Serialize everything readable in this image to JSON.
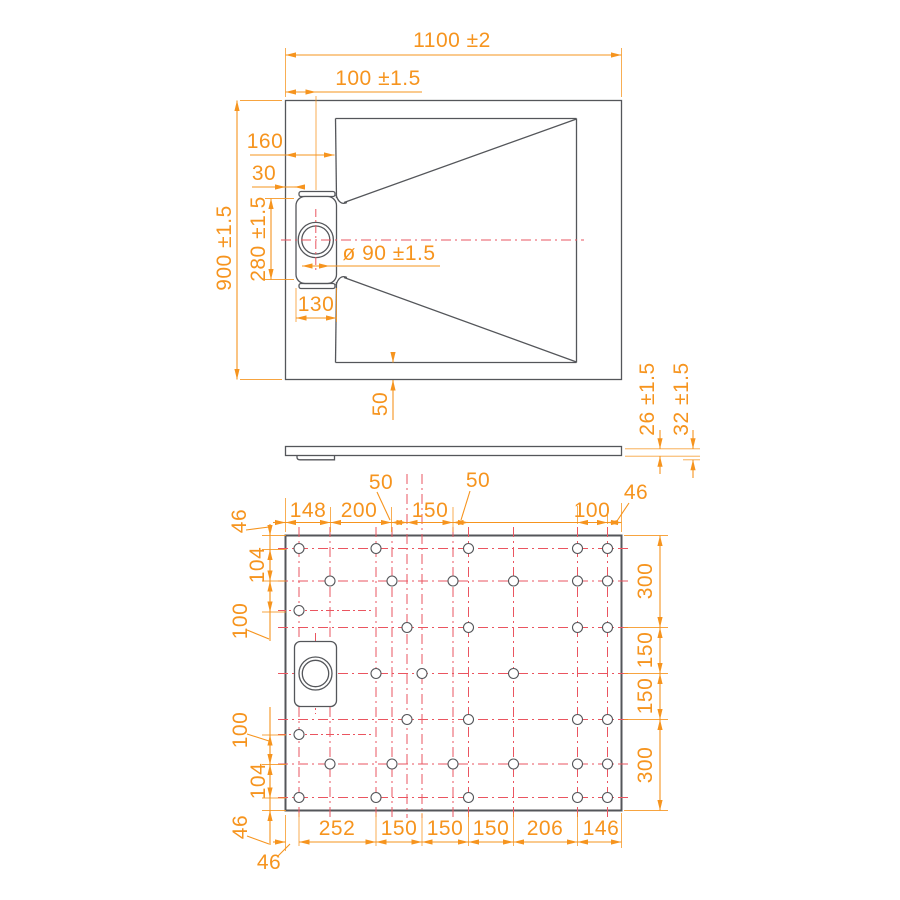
{
  "colors": {
    "dimension": "#F6941E",
    "centerline": "#EA5560",
    "outline": "#54565A",
    "background": "#FFFFFF"
  },
  "top_view": {
    "overall_width": "1100 ±2",
    "drain_center_offset": "100 ±1.5",
    "basin_inset": "160",
    "drain_lip_offset": "30",
    "overall_depth": "900 ±1.5",
    "drain_recess_height": "280 ±1.5",
    "drain_diameter": "ø 90 ±1.5",
    "drain_recess_width": "130",
    "bottom_border": "50"
  },
  "side_view": {
    "rim_thickness": "26 ±1.5",
    "base_thickness": "32 ±1.5"
  },
  "bottom_view": {
    "top_offsets": [
      "50",
      "50"
    ],
    "top_dims": [
      "148",
      "200",
      "150",
      "100"
    ],
    "top_right_margin": "46",
    "left_dims": [
      "46",
      "104",
      "100",
      "100",
      "104",
      "46"
    ],
    "right_dims": [
      "300",
      "150",
      "150",
      "300"
    ],
    "bottom_dims": [
      "252",
      "150",
      "150",
      "150",
      "206",
      "146"
    ],
    "bottom_left_margin": "46"
  }
}
